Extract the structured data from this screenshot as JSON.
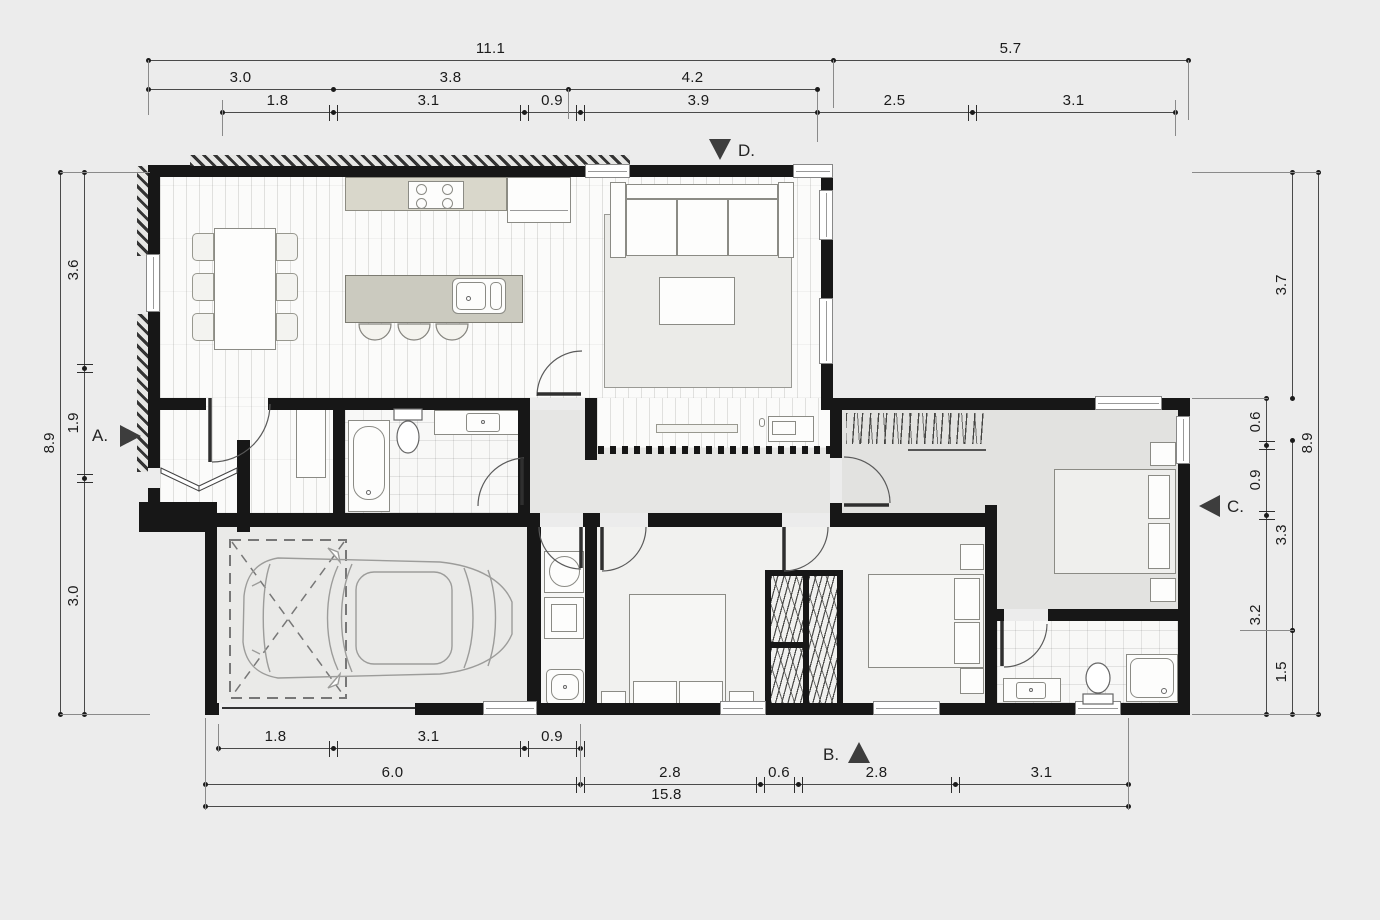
{
  "markers": {
    "a": "A.",
    "b": "B.",
    "c": "C.",
    "d": "D."
  },
  "dims": {
    "top1": [
      "11.1",
      "5.7"
    ],
    "top2": [
      "3.0",
      "3.8",
      "4.2"
    ],
    "top3": [
      "1.8",
      "3.1",
      "0.9",
      "3.9",
      "2.5",
      "3.1"
    ],
    "left_outer": "8.9",
    "left_inner": [
      "3.6",
      "1.9",
      "3.0"
    ],
    "right_a": [
      "0.6",
      "0.9",
      "3.2"
    ],
    "right_b": [
      "3.7",
      "3.3",
      "1.5"
    ],
    "right_outer": "8.9",
    "bottom1": [
      "1.8",
      "3.1",
      "0.9"
    ],
    "bottom2": [
      "6.0",
      "2.8",
      "0.6",
      "2.8",
      "3.1"
    ],
    "bottom3": "15.8"
  }
}
